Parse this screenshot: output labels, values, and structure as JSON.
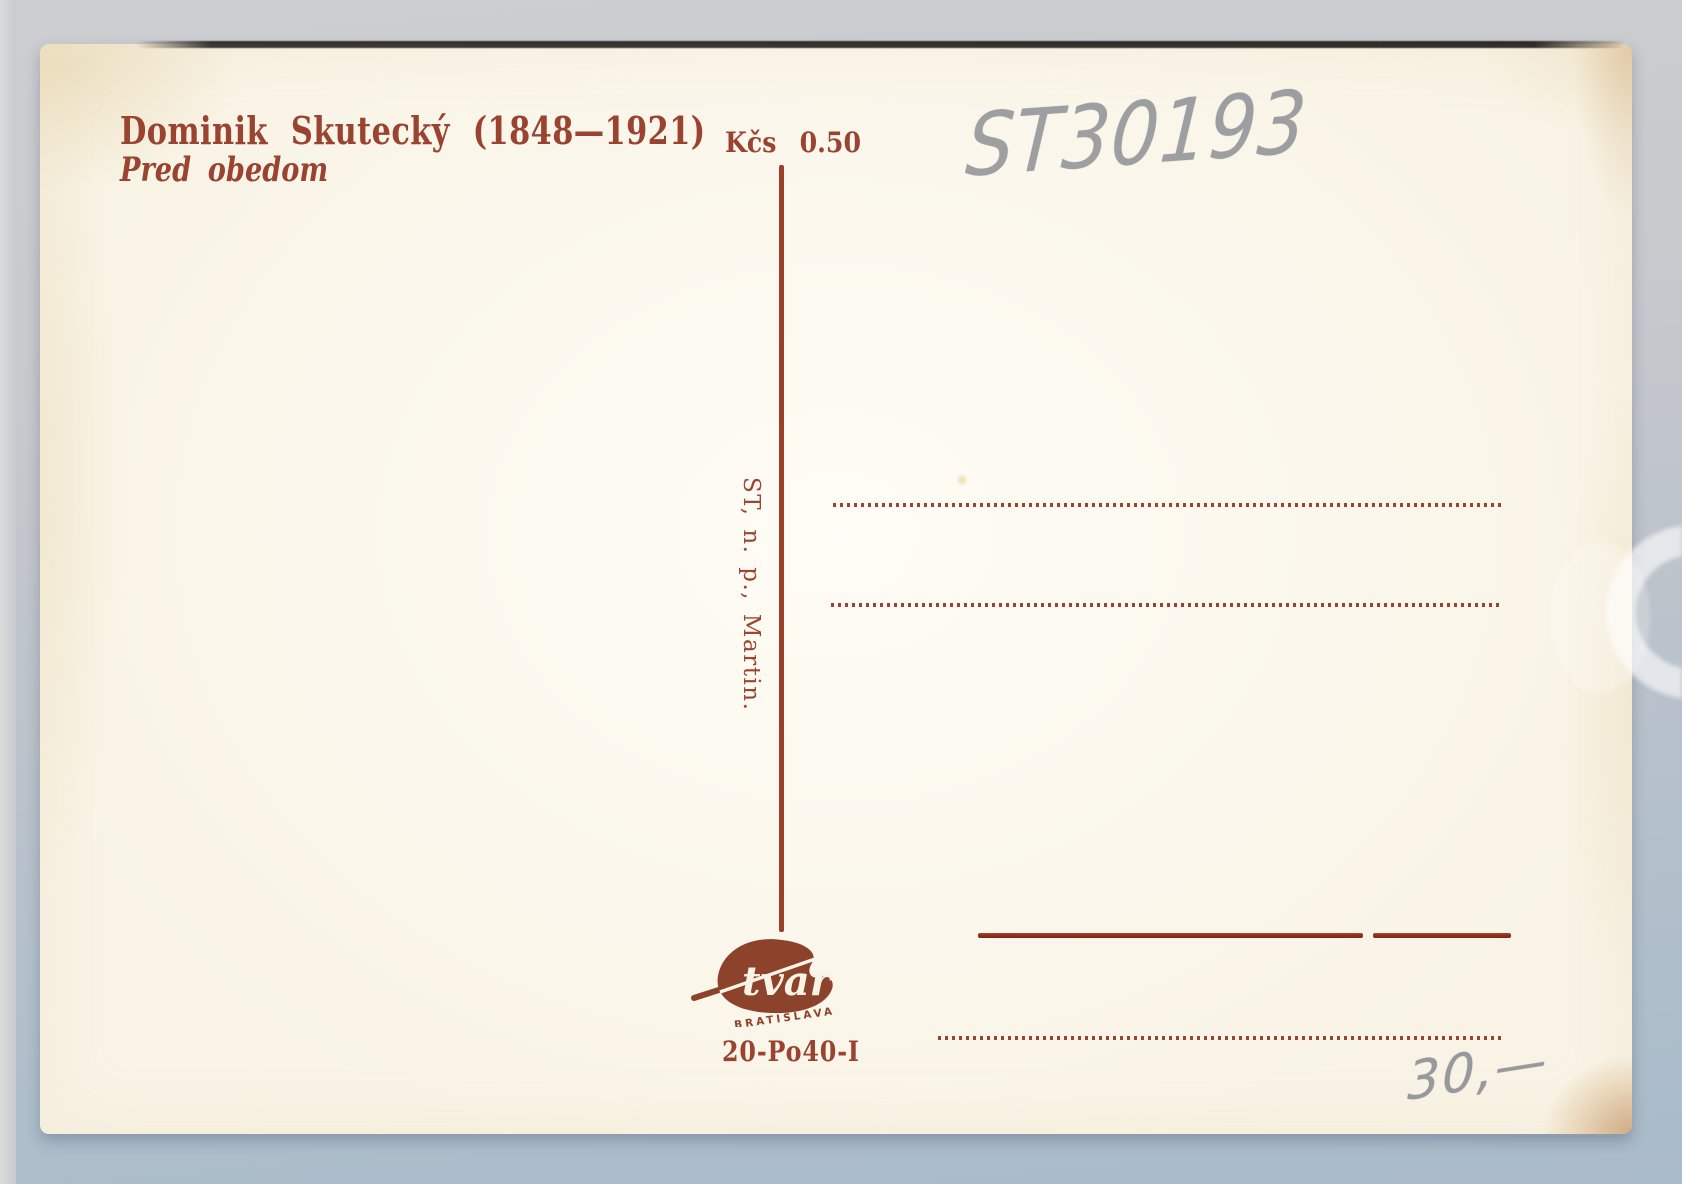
{
  "postcard": {
    "artist_line": "Dominik Skutecký (1848—1921)",
    "title_line": "Pred obedom",
    "price": "Kčs 0.50",
    "publisher_imprint": "ST, n. p., Martin.",
    "print_code": "20-Po40-I",
    "publisher_logo": {
      "name": "tvar",
      "city": "BRATISLAVA"
    }
  },
  "handwriting": {
    "inventory_number": "ST30193",
    "dealer_price": "30,—"
  },
  "colors": {
    "print_brown": "#9a4330",
    "rule_red": "#8c2c1c",
    "logo_brown": "#8d422c",
    "pencil_gray": "#8d9095",
    "card_cream": "#f9f5e9",
    "backdrop_top": "#cdced2",
    "backdrop_bottom": "#a9bac9"
  }
}
